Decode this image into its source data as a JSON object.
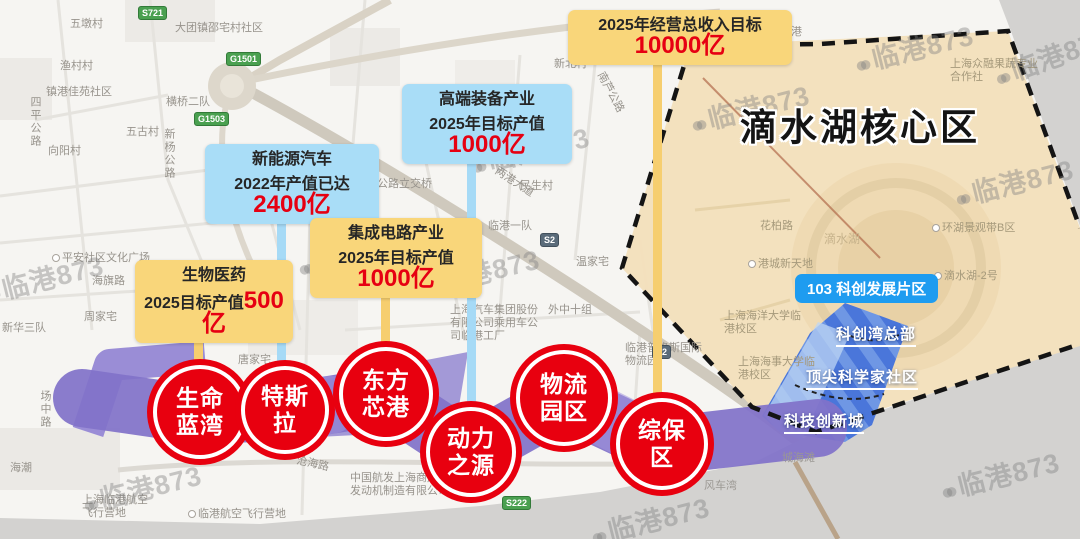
{
  "region": {
    "core_title": "滴水湖核心区",
    "district_badge": "103 科创发展片区",
    "sub_zones": [
      "科创湾总部",
      "顶尖科学家社区",
      "科技创新城"
    ]
  },
  "callouts": [
    {
      "name": "revenue-target",
      "color": "yellow",
      "title": "",
      "prefix": "2025年经营总收入目标",
      "value": "10000亿"
    },
    {
      "name": "high-end-equipment",
      "color": "blue",
      "title": "高端装备产业",
      "prefix": "2025年目标产值",
      "value": "1000亿"
    },
    {
      "name": "new-energy-vehicle",
      "color": "blue",
      "title": "新能源汽车",
      "prefix": "2022年产值已达",
      "value": "2400亿"
    },
    {
      "name": "integrated-circuit",
      "color": "yellow",
      "title": "集成电路产业",
      "prefix": "2025年目标产值",
      "value": "1000亿"
    },
    {
      "name": "biomedicine",
      "color": "yellow",
      "title": "生物医药",
      "prefix": "2025目标产值",
      "value": "500亿"
    }
  ],
  "parks": [
    "生命蓝湾",
    "特斯拉",
    "东方芯港",
    "动力之源",
    "物流园区",
    "综保区"
  ],
  "watermark_text": "临港873",
  "road_badges": [
    "S721",
    "G1501",
    "G1503",
    "S2",
    "S2",
    "S222"
  ],
  "map_labels": [
    "五墩村",
    "大团镇邵宅村社区",
    "渔村村",
    "镇港佳苑社区",
    "横桥二队",
    "五古村",
    "向阳村",
    "四平公路",
    "新杨公路",
    "平安社区文化广场",
    "海旗路",
    "周家宅",
    "新华三队",
    "场中路",
    "海潮",
    "上海临港航空飞行营地",
    "临港航空飞行营地",
    "中国航发上海商用航空发动机制造有限公司",
    "沧海路",
    "唐家宅",
    "Y5桥",
    "民生村",
    "临港一队",
    "温家宅",
    "外中十组",
    "上海汽车集团股份有限公司乘用车公司临港工厂",
    "临港普洛斯国际物流园",
    "南芦公路立交桥",
    "泥城路",
    "宋家宅",
    "新北村",
    "花柏路",
    "港城新天地",
    "环湖景观带B区",
    "滴水湖-2号",
    "滴水湖",
    "滨海花港",
    "上海众融果蔬专业合作社",
    "上海海洋大学临港校区",
    "上海海事大学临港校区",
    "两港大道",
    "南芦公路",
    "风车湾",
    "城海滩"
  ],
  "colors": {
    "callout_yellow": "#f9d67a",
    "callout_blue": "#a9ddf7",
    "highlight_red": "#e60012",
    "park_red": "#e8000f",
    "core_area_beige": "#f3e0bc",
    "district_blue": "#4a76da",
    "badge_blue": "#1e9cf0",
    "corridor_purple": "#8172c9",
    "sea_gray": "#d3d2d0"
  }
}
